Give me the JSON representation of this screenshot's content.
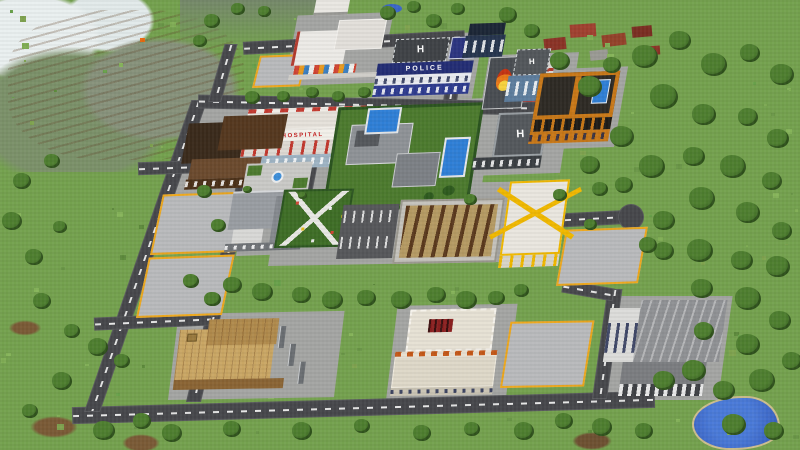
{
  "scene": {
    "game": "Minecraft",
    "description": "Aerial isometric view of a city build surrounded by forest, with a snowy mountain top-left and a pond bottom-right"
  },
  "signs": {
    "police": "POLICE",
    "hospital": "HOSPITAL",
    "helipad": "H"
  },
  "colors": {
    "grass": "#74a14e",
    "forest": "#31591e",
    "road": "#46474b",
    "road_line": "#e6e6e6",
    "lot": "#b9babc",
    "lot_marking": "#eda71c",
    "police_blue": "#2e3b8e",
    "hospital_red": "#c41f1f",
    "pool": "#2f7fd6",
    "wood": "#c9a664",
    "orange_bldg": "#c87818",
    "construction_yellow": "#f0b800",
    "snow": "#e9efef",
    "water": "#3a66c8",
    "warehouse": "#8f9194"
  }
}
